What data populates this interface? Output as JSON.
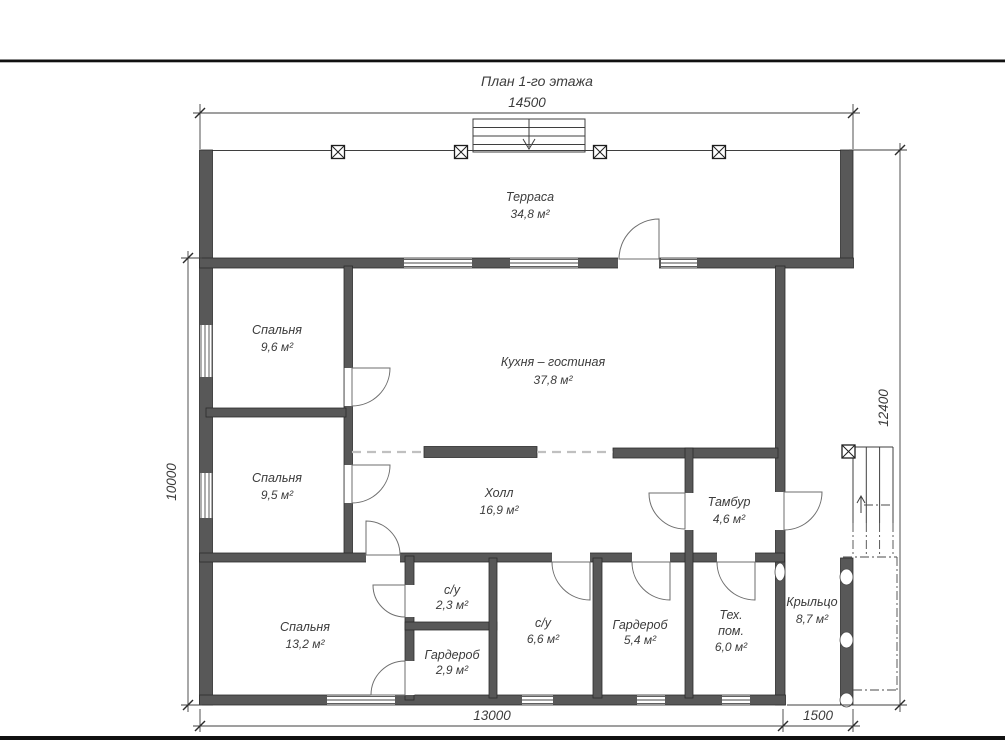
{
  "title": "План 1-го этажа",
  "dims": {
    "top": "14500",
    "left": "10000",
    "right": "12400",
    "bottom_main": "13000",
    "bottom_porch": "1500"
  },
  "rooms": [
    {
      "name": "Терраса",
      "area": "34,8 м²"
    },
    {
      "name": "Спальня",
      "area": "9,6 м²"
    },
    {
      "name": "Кухня – гостиная",
      "area": "37,8 м²"
    },
    {
      "name": "Спальня",
      "area": "9,5 м²"
    },
    {
      "name": "Холл",
      "area": "16,9 м²"
    },
    {
      "name": "Тамбур",
      "area": "4,6 м²"
    },
    {
      "name": "Спальня",
      "area": "13,2 м²"
    },
    {
      "name": "с/у",
      "area": "2,3 м²"
    },
    {
      "name": "Гардероб",
      "area": "2,9 м²"
    },
    {
      "name": "с/у",
      "area": "6,6 м²"
    },
    {
      "name": "Гардероб",
      "area": "5,4 м²"
    },
    {
      "name": "Тех.",
      "name2": "пом.",
      "area": "6,0 м²"
    },
    {
      "name": "Крыльцо",
      "area": "8,7 м²"
    }
  ],
  "colors": {
    "wall": "#585858",
    "wall_outline": "#2c2c2c",
    "drawing_line": "#3f3f3f",
    "dashed_opening": "#c0c0c0",
    "text": "#3c3c3c",
    "page_border": "#111111",
    "background": "#ffffff"
  }
}
